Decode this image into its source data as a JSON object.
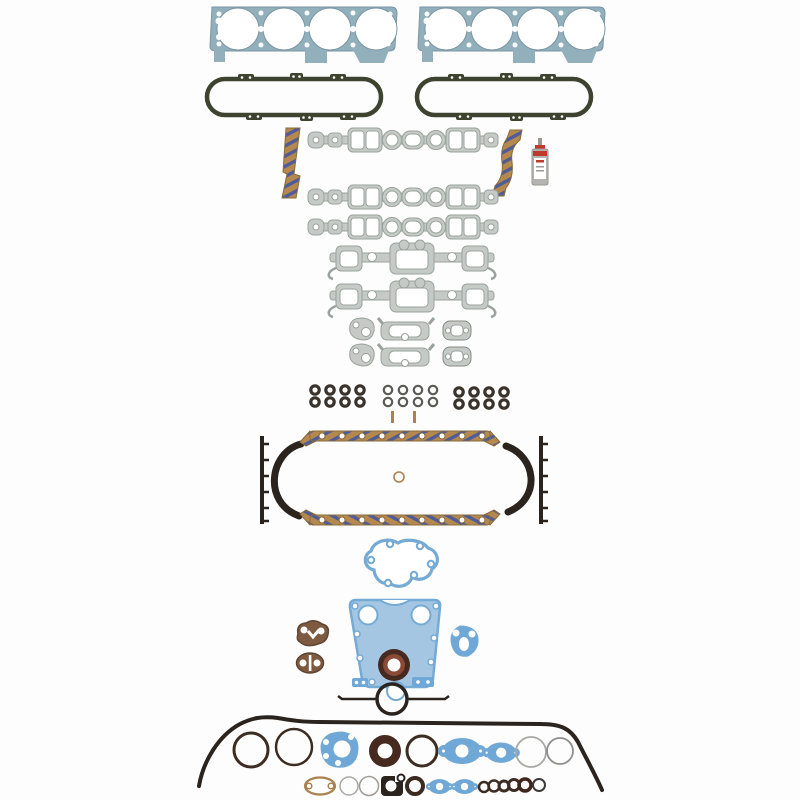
{
  "meta": {
    "description": "Product photo: complete engine full gasket set laid out on a white background",
    "background": "#fdfdfd"
  },
  "colors": {
    "background": "#fdfdfd",
    "head_gasket": "#92afbc",
    "head_gasket_edge": "#7b96a4",
    "valve_cover": "#3e4330",
    "manifold": "#c6cac6",
    "manifold_edge": "#9aa29c",
    "cork": "#b5894d",
    "cork_stripe": "#3d55a5",
    "cork_edge": "#8a6a3a",
    "sealant_body": "#b6b4b0",
    "sealant_red": "#c03a2c",
    "seal_dark": "#3a332c",
    "seal_mid": "#5a5a58",
    "rubber": "#2b241e",
    "blue": "#74aad4",
    "blue_fill": "#a5c6e2",
    "blue_solid": "#6fa8d6",
    "brown": "#7d5a40",
    "brown_edge": "#5f4430",
    "crank_outer": "#46291f",
    "crank_inner": "#8a4a36",
    "tan": "#a9824f",
    "faint": "#a8a8a4",
    "dark_ring": "#3c2c22",
    "white": "#ffffff"
  },
  "inventory": [
    {
      "name": "head-gasket",
      "count": 2,
      "color": "head_gasket"
    },
    {
      "name": "valve-cover-gasket",
      "count": 2,
      "color": "valve_cover"
    },
    {
      "name": "intake-manifold-gasket",
      "count": 3,
      "color": "manifold"
    },
    {
      "name": "intake-end-seal-cork",
      "count": 2,
      "color": "cork"
    },
    {
      "name": "sealant-tube",
      "count": 1,
      "color": "sealant_body"
    },
    {
      "name": "exhaust-manifold-gasket",
      "count": 2,
      "color": "manifold"
    },
    {
      "name": "heat-riser-gasket",
      "count": 6,
      "color": "manifold"
    },
    {
      "name": "valve-stem-seal",
      "count": 24,
      "color": "seal_dark"
    },
    {
      "name": "dowel-pin",
      "count": 2,
      "color": "tan"
    },
    {
      "name": "oil-pan-rail-cork",
      "count": 2,
      "color": "cork"
    },
    {
      "name": "oil-pan-end-seal",
      "count": 2,
      "color": "rubber"
    },
    {
      "name": "oil-pan-side-strip",
      "count": 2,
      "color": "rubber"
    },
    {
      "name": "center-o-ring",
      "count": 1,
      "color": "tan"
    },
    {
      "name": "water-pump-gasket",
      "count": 1,
      "color": "blue"
    },
    {
      "name": "timing-cover-gasket",
      "count": 1,
      "color": "blue_fill"
    },
    {
      "name": "fuel-pump-gasket",
      "count": 2,
      "color": "brown"
    },
    {
      "name": "bypass-gasket",
      "count": 1,
      "color": "blue_solid"
    },
    {
      "name": "front-crank-seal",
      "count": 1,
      "color": "crank_outer"
    },
    {
      "name": "rear-main-seal",
      "count": 1,
      "color": "rubber"
    },
    {
      "name": "rear-seal-side-tab",
      "count": 2,
      "color": "blue_solid"
    },
    {
      "name": "one-piece-perimeter-gasket",
      "count": 1,
      "color": "rubber"
    },
    {
      "name": "o-ring-large",
      "count": 3,
      "color": "dark_ring"
    },
    {
      "name": "carb-base-gasket",
      "count": 1,
      "color": "blue_solid"
    },
    {
      "name": "aux-shaft-seal",
      "count": 2,
      "color": "crank_outer"
    },
    {
      "name": "thermostat-outlet-gasket",
      "count": 2,
      "color": "blue_solid"
    },
    {
      "name": "shim-ring",
      "count": 4,
      "color": "faint"
    },
    {
      "name": "tan-oval-gasket",
      "count": 1,
      "color": "tan"
    },
    {
      "name": "cam-plug-gasket",
      "count": 1,
      "color": "rubber"
    },
    {
      "name": "small-blue-gasket",
      "count": 2,
      "color": "blue_solid"
    },
    {
      "name": "small-seal-ring",
      "count": 6,
      "color": "dark_ring"
    }
  ]
}
